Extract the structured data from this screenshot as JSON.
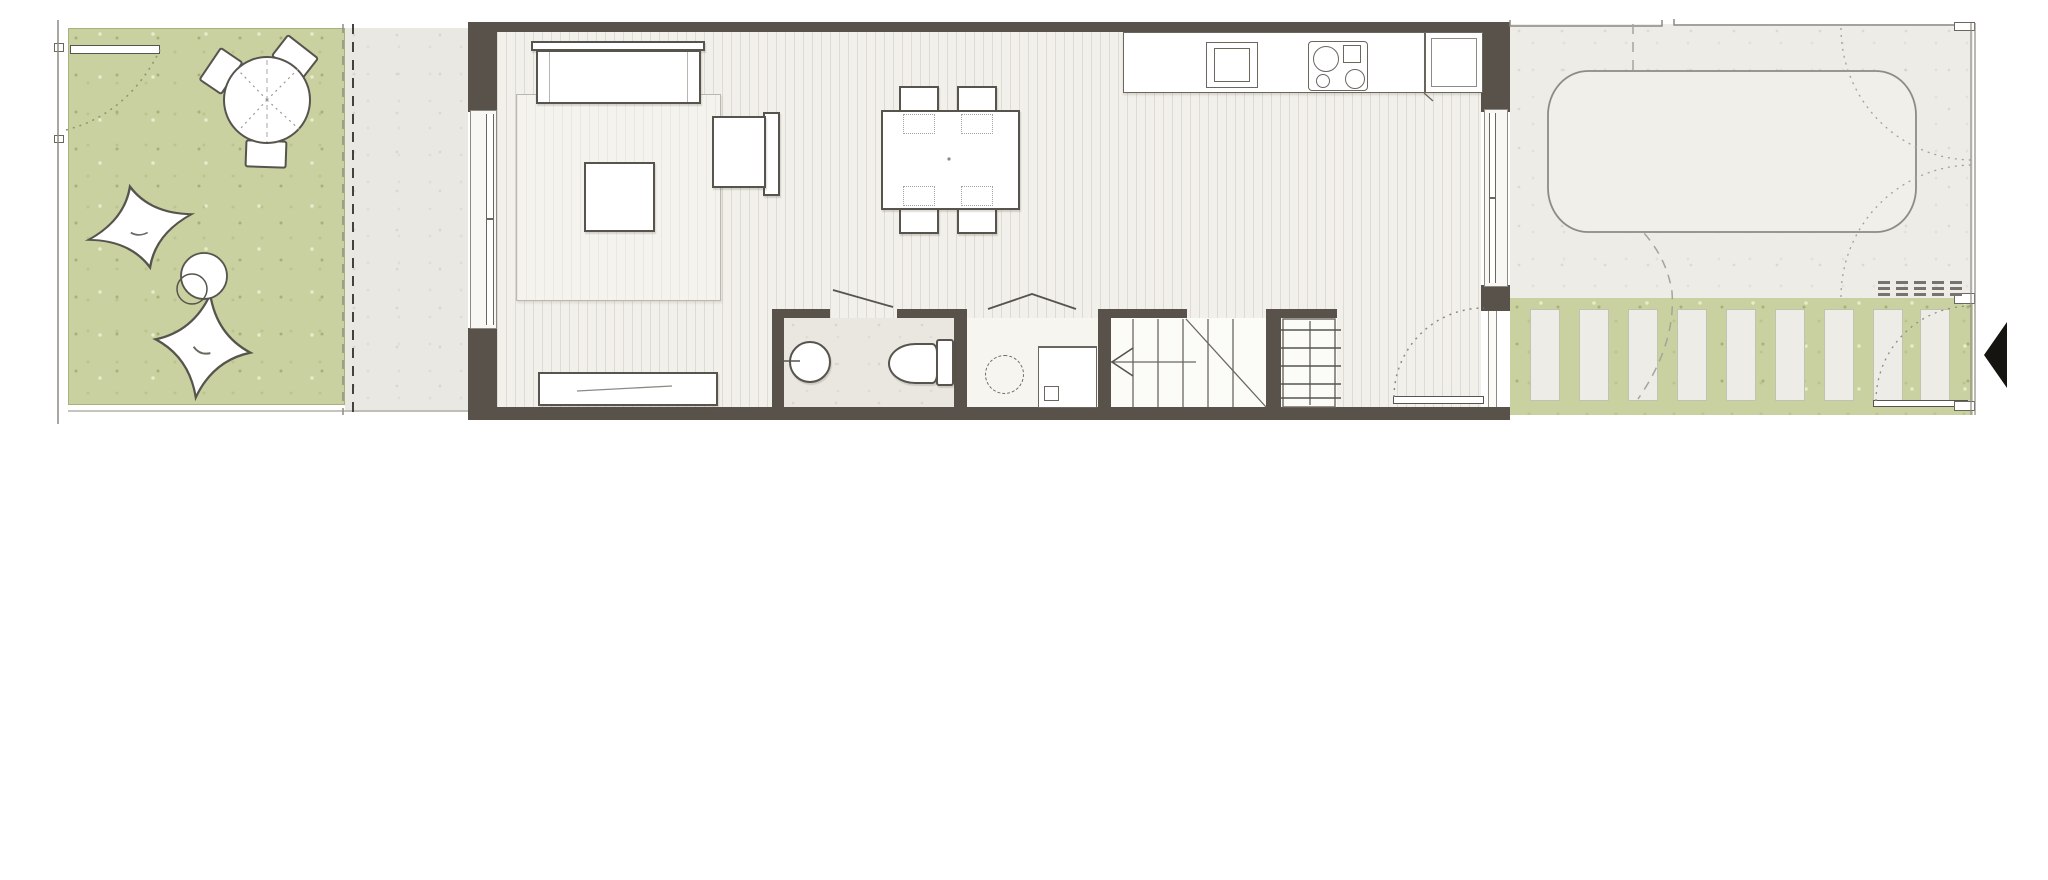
{
  "title": "ground-floor-plan",
  "canvas": {
    "width": 2048,
    "height": 880
  },
  "palette": {
    "wall": "#59524a",
    "line": "#57544d",
    "line_light": "#8d8a84",
    "grass": "#c9d1a0",
    "concrete": "#eae8e2",
    "driveway": "#edece6",
    "floor": "#f2f0ea",
    "rug": "#f5f3ee",
    "fixture": "#ffffff",
    "entrance_marker": "#161410"
  },
  "site": {
    "garden": {
      "position": "west",
      "furniture": [
        "round-table",
        "garden-chair",
        "garden-chair",
        "garden-chair",
        "lounger-cushion",
        "lounger-cushion",
        "side-table"
      ],
      "chair_count": 3,
      "lounger_count": 2,
      "boundary": "double-dashed-line"
    },
    "terrace": {
      "position": "between-garden-and-house",
      "surface": "concrete"
    },
    "driveway": {
      "position": "east",
      "vehicle": "car-outline",
      "gate": "double-swing-gate-dotted-arcs",
      "property_line": "dashed"
    },
    "garden_path": {
      "paver_count": 9,
      "surface": "grass-with-concrete-pavers",
      "pedestrian_gate": "open-leaf-with-dotted-swing-arc"
    },
    "entrance_marker": "solid-black-arrow-pointing-left"
  },
  "house": {
    "wall_style": "thick-dark-brown",
    "windows": [
      "west-full-height-window",
      "east-window"
    ],
    "entrance": "east-door-open-with-swing-arc",
    "rooms": [
      {
        "name": "living-area",
        "furniture": [
          "sofa",
          "armchair",
          "coffee-table",
          "area-rug",
          "tv-sideboard"
        ]
      },
      {
        "name": "dining-area",
        "furniture": [
          "dining-table"
        ],
        "chair_count": 4
      },
      {
        "name": "kitchen",
        "fixtures": [
          "counter-run",
          "sink",
          "cooktop",
          "tall-cabinet"
        ],
        "cooktop_burners": 4
      },
      {
        "name": "bathroom",
        "fixtures": [
          "washbasin",
          "toilet"
        ],
        "door": "single-leaf-ajar"
      },
      {
        "name": "utility-closet",
        "fixtures": [
          "washing-machine",
          "counter"
        ],
        "door": "bifold-pair"
      },
      {
        "name": "staircase",
        "tread_lines": 5,
        "direction_arrow": "points-west"
      },
      {
        "name": "wardrobe-shelves",
        "shelf_lines": 5
      }
    ]
  }
}
